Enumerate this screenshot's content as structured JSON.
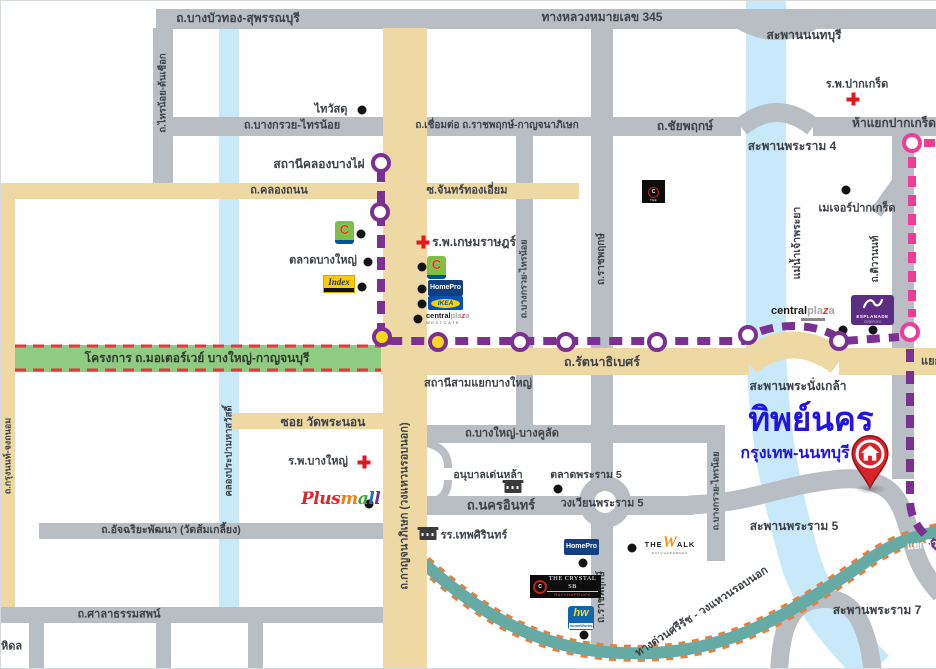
{
  "map": {
    "colors": {
      "mrt_purple": "#7b3092",
      "mrt_pink": "#ee3d96",
      "station_yellow": "#f6d81c",
      "expressway_teal": "#66aaa4",
      "expressway_dash_orange": "#ef7d3a",
      "motorway_green": "#90cb83",
      "motorway_dash_red": "#e8363b",
      "road_gray": "#b9bec4",
      "road_tan": "#eed9a4",
      "water_blue": "#c8e9fa",
      "destination_blue": "#2215e0"
    },
    "labels": [
      {
        "n": "road-label-bangbuathong-suphanburi",
        "t": "ถ.บางบัวทอง-สุพรรณบุรี",
        "x": 237,
        "y": 17,
        "fs": 12
      },
      {
        "n": "road-label-highway-345",
        "t": "ทางหลวงหมายเลข 345",
        "x": 601,
        "y": 16,
        "fs": 12
      },
      {
        "n": "road-label-bangkruai-sainoi",
        "t": "ถ.บางกรวย-ไทรน้อย",
        "x": 291,
        "y": 125,
        "fs": 11
      },
      {
        "n": "road-label-connect-ratchaphruek",
        "t": "ถ.เชื่อมต่อ ถ.ราชพฤกษ์-กาญจนาภิเษก",
        "x": 496,
        "y": 125,
        "fs": 10
      },
      {
        "n": "road-label-chaiyaphruek",
        "t": "ถ.ชัยพฤกษ์",
        "x": 684,
        "y": 125,
        "fs": 12
      },
      {
        "n": "road-label-khlong-thanon",
        "t": "ถ.คลองถนน",
        "x": 278,
        "y": 190,
        "fs": 11
      },
      {
        "n": "road-label-soi-chanthong-iam",
        "t": "ซ.จันทร์ทองเอี่ยม",
        "x": 466,
        "y": 190,
        "fs": 11
      },
      {
        "n": "motorway-project-label",
        "t": "โครงการ ถ.มอเตอร์เวย์ บางใหญ่-กาญจนบุรี",
        "x": 196,
        "y": 357,
        "fs": 12,
        "c": "#2f3b2c"
      },
      {
        "n": "road-label-rattanathibet",
        "t": "ถ.รัตนาธิเบศร์",
        "x": 601,
        "y": 361,
        "fs": 12.5
      },
      {
        "n": "road-label-yaek",
        "t": "แยก",
        "x": 920,
        "y": 361,
        "fs": 11,
        "a": "l"
      },
      {
        "n": "road-label-soi-wat-phranon",
        "t": "ซอย วัดพระนอน",
        "x": 322,
        "y": 421,
        "fs": 12
      },
      {
        "n": "road-label-bangyai-bangkhulat",
        "t": "ถ.บางใหญ่-บางคูลัด",
        "x": 511,
        "y": 433,
        "fs": 11
      },
      {
        "n": "road-label-nakhon-in",
        "t": "ถ.นครอินทร์",
        "x": 500,
        "y": 504,
        "fs": 13
      },
      {
        "n": "label-wongwian-rama5",
        "t": "วงเวียนพระราม 5",
        "x": 601,
        "y": 503,
        "fs": 11
      },
      {
        "n": "road-label-atchariya-phatthana",
        "t": "ถ.อัจฉริยะพัฒนา (วัดส้มเกลี้ยง)",
        "x": 170,
        "y": 529,
        "fs": 10.5
      },
      {
        "n": "road-label-salathammasop",
        "t": "ถ.ศาลาธรรมสพน์",
        "x": 118,
        "y": 614,
        "fs": 11
      },
      {
        "n": "expressway-label-sirat",
        "t": "ทางด่วนศรีรัช - วงแหวนรอบนอก",
        "x": 701,
        "y": 611,
        "fs": 11,
        "r": -33
      },
      {
        "n": "expressway-label-yaek-tiwanon",
        "t": "แยกติว",
        "x": 906,
        "y": 545,
        "fs": 10,
        "c": "#ffffff",
        "a": "l",
        "r": -6
      },
      {
        "n": "bridge-label-nonthaburi",
        "t": "สะพานนนทบุรี",
        "x": 803,
        "y": 34,
        "fs": 12
      },
      {
        "n": "bridge-label-rama4",
        "t": "สะพานพระราม 4",
        "x": 791,
        "y": 145,
        "fs": 12
      },
      {
        "n": "junction-label-hayaek-pakkret",
        "t": "ห้าแยกปากเกร็ด",
        "x": 893,
        "y": 122,
        "fs": 12
      },
      {
        "n": "bridge-label-phranangklao",
        "t": "สะพานพระนั่งเกล้า",
        "x": 797,
        "y": 385,
        "fs": 12
      },
      {
        "n": "bridge-label-rama5",
        "t": "สะพานพระราม 5",
        "x": 793,
        "y": 525,
        "fs": 12
      },
      {
        "n": "bridge-label-rama7",
        "t": "สะพานพระราม 7",
        "x": 876,
        "y": 609,
        "fs": 12
      },
      {
        "n": "station-label-khlong-bang-phai",
        "t": "สถานีคลองบางไผ่",
        "x": 318,
        "y": 163,
        "fs": 12
      },
      {
        "n": "station-label-samyaek-bangyai",
        "t": "สถานีสามแยกบางใหญ่",
        "x": 477,
        "y": 383,
        "fs": 11
      },
      {
        "n": "poi-label-thaiwatsadu",
        "t": "ไทวัสดุ",
        "x": 330,
        "y": 109,
        "fs": 11
      },
      {
        "n": "poi-label-talat-bangyai",
        "t": "ตลาดบางใหญ่",
        "x": 322,
        "y": 260,
        "fs": 11
      },
      {
        "n": "poi-label-kasemrad-hospital",
        "t": "ร.พ.เกษมราษฎร์",
        "x": 473,
        "y": 241,
        "fs": 12
      },
      {
        "n": "poi-label-pakkret-hospital",
        "t": "ร.พ.ปากเกร็ด",
        "x": 856,
        "y": 84,
        "fs": 11
      },
      {
        "n": "poi-label-bangyai-hospital",
        "t": "ร.พ.บางใหญ่",
        "x": 317,
        "y": 461,
        "fs": 11
      },
      {
        "n": "poi-label-major-pakkret",
        "t": "เมเจอร์ปากเกร็ด",
        "x": 856,
        "y": 208,
        "fs": 11
      },
      {
        "n": "poi-label-talat-rama5",
        "t": "ตลาดพระราม 5",
        "x": 585,
        "y": 474,
        "fs": 10.5
      },
      {
        "n": "poi-label-denla-kindergarten",
        "t": "อนุบาลเด่นหล้า",
        "x": 487,
        "y": 474,
        "fs": 10.5
      },
      {
        "n": "poi-label-debsirin-school",
        "t": "รร.เทพศิรินทร์",
        "x": 473,
        "y": 535,
        "fs": 11
      },
      {
        "n": "label-mahidol-partial",
        "t": "หิดล",
        "x": 0,
        "y": 646,
        "fs": 11,
        "a": "l"
      },
      {
        "n": "destination-title",
        "t": "ทิพย์นคร",
        "x": 810,
        "y": 418,
        "fs": 33,
        "c": "#2215e0",
        "fw": 800
      },
      {
        "n": "destination-subtitle",
        "t": "กรุงเทพ-นนทบุรี",
        "x": 794,
        "y": 453,
        "fs": 16,
        "c": "#2215e0"
      },
      {
        "n": "road-label-sainoi-tonchueak",
        "t": "ถ.ไทรน้อย-ต้นเชือก",
        "x": 162,
        "y": 92,
        "fs": 9.5,
        "r": -90
      },
      {
        "n": "road-label-krungnon-chongthanom",
        "t": "ถ.กรุงนนท์-จงถนอม",
        "x": 7,
        "y": 455,
        "fs": 9,
        "r": -90
      },
      {
        "n": "canal-label-prapa-mahasawat",
        "t": "คลองประปามหาสวัสดิ์",
        "x": 228,
        "y": 450,
        "fs": 9.5,
        "r": -90
      },
      {
        "n": "road-label-kanchanaphisek",
        "t": "ถ.กาญจนาภิเษก (วงแหวนรอบนอก)",
        "x": 404,
        "y": 505,
        "fs": 11,
        "r": -90
      },
      {
        "n": "road-label-bangkruai-sainoi-v1",
        "t": "ถ.บางกรวย-ไทรน้อย",
        "x": 523,
        "y": 278,
        "fs": 9,
        "r": -90
      },
      {
        "n": "road-label-ratchaphruek-v1",
        "t": "ถ.ราชพฤกษ์",
        "x": 601,
        "y": 258,
        "fs": 10,
        "r": -90
      },
      {
        "n": "road-label-ratchaphruek-v2",
        "t": "ถ.ราชพฤกษ์",
        "x": 601,
        "y": 596,
        "fs": 10,
        "r": -90
      },
      {
        "n": "road-label-bangkruai-sainoi-v2",
        "t": "ถ.บางกรวย-ไทรน้อย",
        "x": 715,
        "y": 490,
        "fs": 9,
        "r": -90
      },
      {
        "n": "road-label-tiwanon",
        "t": "ถ.ติวานนท์",
        "x": 875,
        "y": 258,
        "fs": 10,
        "r": -90
      },
      {
        "n": "river-label-chaophraya",
        "t": "แม่น้ำเจ้าพระยา",
        "x": 796,
        "y": 242,
        "fs": 10.5,
        "r": -90
      }
    ],
    "dots": [
      [
        361,
        109
      ],
      [
        360,
        233
      ],
      [
        367,
        261
      ],
      [
        361,
        286
      ],
      [
        421,
        266
      ],
      [
        421,
        288
      ],
      [
        421,
        303
      ],
      [
        417,
        318
      ],
      [
        845,
        189
      ],
      [
        842,
        329
      ],
      [
        872,
        329
      ],
      [
        557,
        488
      ],
      [
        631,
        547
      ],
      [
        582,
        562
      ],
      [
        583,
        634
      ],
      [
        368,
        503
      ]
    ],
    "hospital_crosses": [
      [
        422,
        241
      ],
      [
        852,
        98
      ],
      [
        363,
        461
      ]
    ],
    "school_icons": [
      [
        512,
        487
      ],
      [
        427,
        534
      ]
    ],
    "mrt_stations": {
      "purple": [
        {
          "x": 380,
          "y": 162,
          "fill": "#ffffff"
        },
        {
          "x": 379,
          "y": 211,
          "fill": "#ffffff"
        },
        {
          "x": 381,
          "y": 336,
          "fill": "#f6d81c"
        },
        {
          "x": 437,
          "y": 341,
          "fill": "#f6d81c"
        },
        {
          "x": 519,
          "y": 341,
          "fill": "#ffffff"
        },
        {
          "x": 565,
          "y": 341,
          "fill": "#ffffff"
        },
        {
          "x": 656,
          "y": 341,
          "fill": "#ffffff"
        },
        {
          "x": 747,
          "y": 334,
          "fill": "#ffffff"
        },
        {
          "x": 838,
          "y": 340,
          "fill": "#ffffff"
        }
      ],
      "pink": [
        {
          "x": 911,
          "y": 142,
          "fill": "#ffffff"
        },
        {
          "x": 909,
          "y": 331,
          "fill": "#ffffff"
        }
      ]
    },
    "logos": {
      "bigc": {
        "letter": "C"
      },
      "index": {
        "text": "Index"
      },
      "homepro": {
        "text": "HomePro"
      },
      "ikea": {
        "text": "IKEA"
      },
      "centralplaza": {
        "part1": "central",
        "part2": "pla",
        "z": "z",
        "part3": "a",
        "sub": "WESTGATE"
      },
      "esplanade": {
        "line1": "ESPLANADE",
        "line2": "CINEPLEX"
      },
      "crystal_small": {
        "letter": "C",
        "text": "THE CRYSTAL"
      },
      "crystal_sb": {
        "letter": "C",
        "line1": "THE CRYSTAL SB",
        "line2": "RATCHAPRUEK"
      },
      "thewalk": {
        "a": "THE",
        "w": "W",
        "b": "ALK",
        "sub": "RATCHAPHRUEK"
      },
      "hw": {
        "text": "hw",
        "sub": "homeWorks"
      },
      "plusmall": {
        "text": "Plusmall",
        "colors": [
          "#e0252a",
          "#e0252a",
          "#e0252a",
          "#e0252a",
          "#e8821e",
          "#3aaa35",
          "#1d70b7",
          "#7b3092"
        ]
      }
    }
  }
}
